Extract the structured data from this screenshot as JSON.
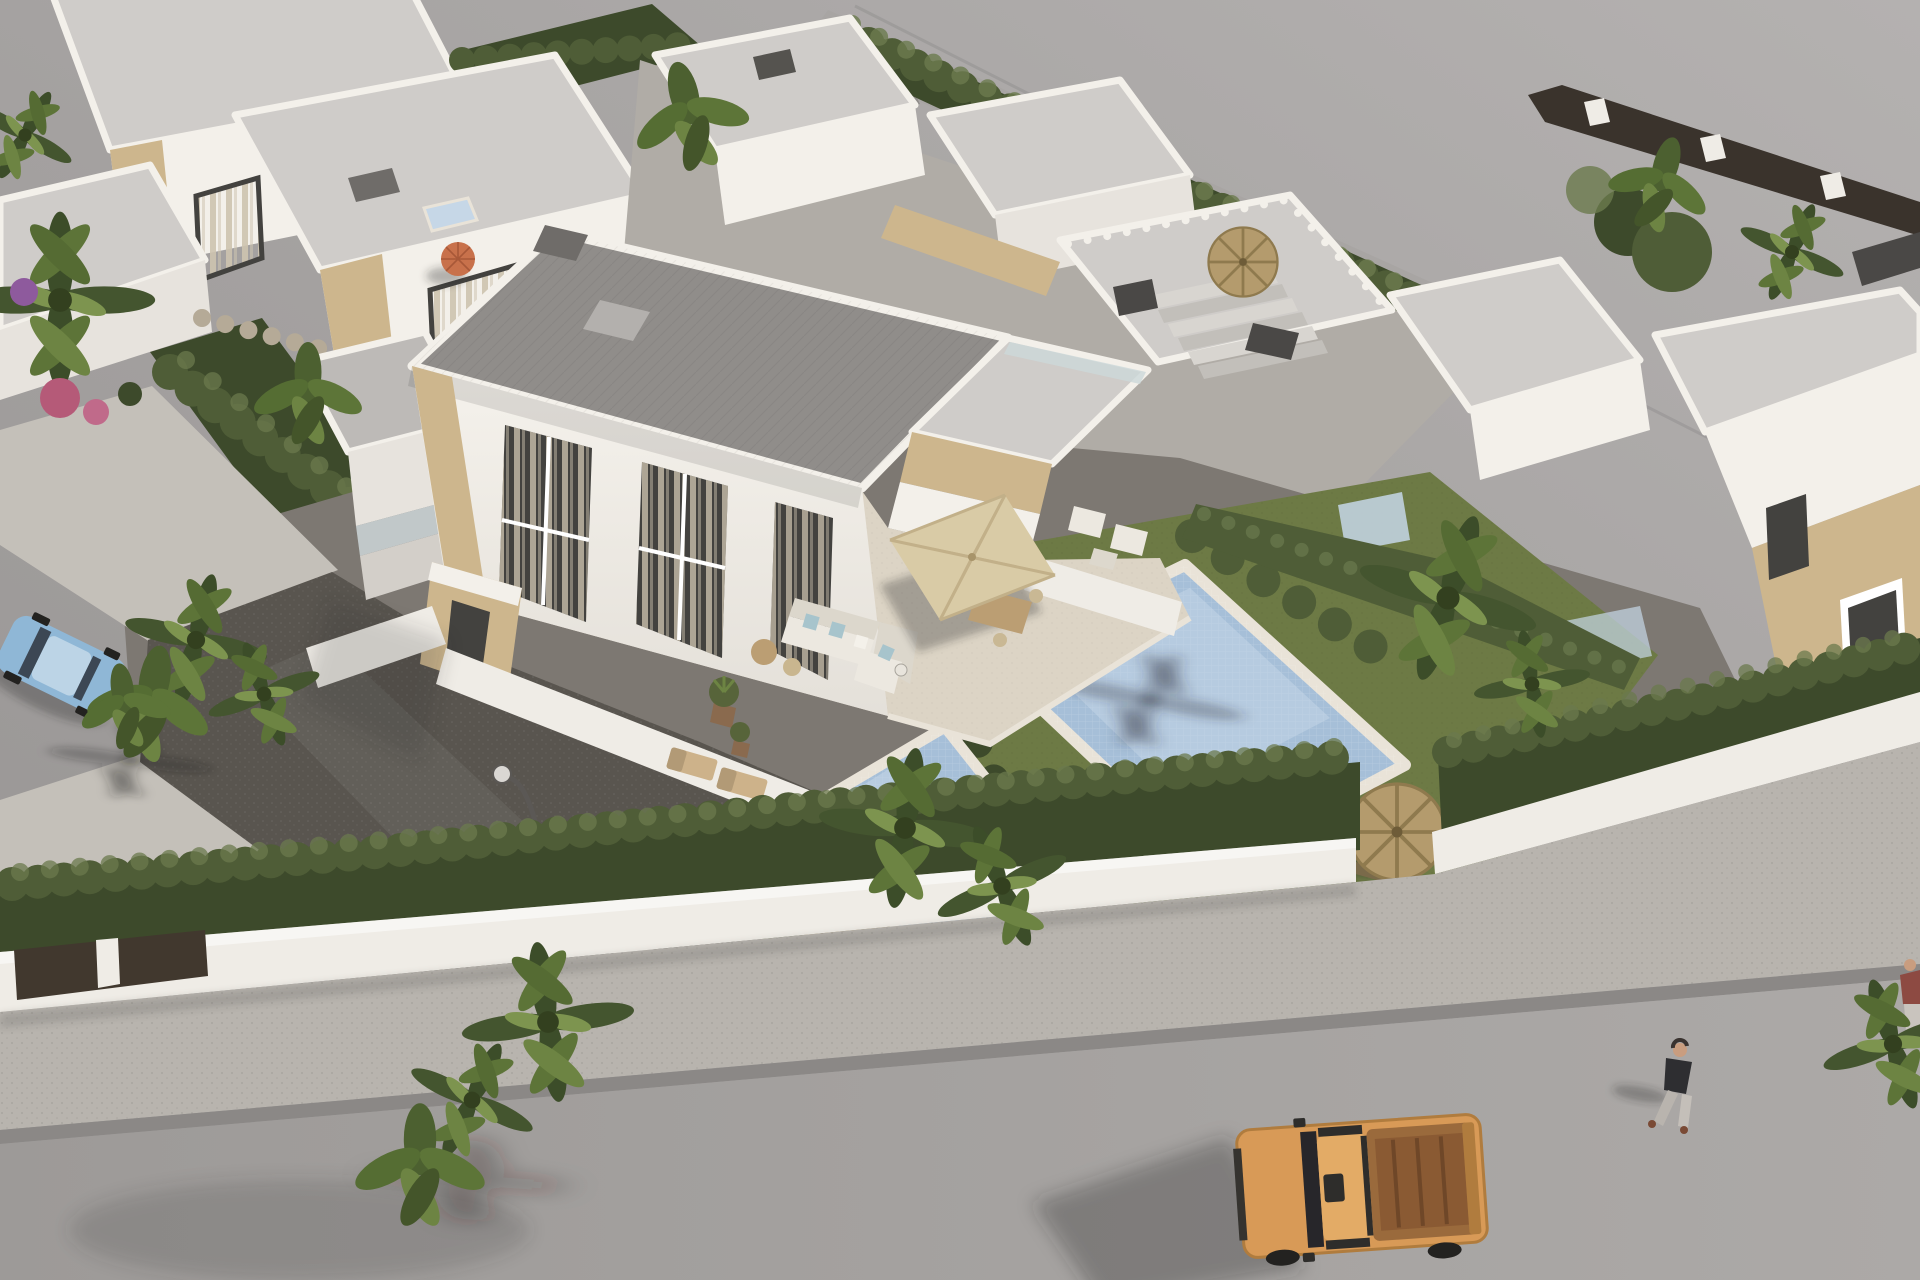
{
  "meta": {
    "title": "Aerial 3D architectural render of a new-build residential development: white flat-roof villas with stone accents, private mosaic pools, landscaped gardens and a street with vehicles",
    "view": "high-angle aerial",
    "time_of_day": "daytime"
  },
  "palette": {
    "bg1": "#b2afae",
    "bg2": "#989594",
    "roofL": "#cfccc9",
    "roofM": "#bdbab7",
    "roofD": "#908d8a",
    "wallB": "#f3f0ea",
    "wallL": "#e7e3dd",
    "wallS": "#d3cfc9",
    "wallD": "#c0bcb6",
    "stone": "#cdb68d",
    "stoneD": "#b29873",
    "glass": "#43423f",
    "curtain": "#cec4b0",
    "terr": "#dcd4c5",
    "terrS": "#cbc2b0",
    "poolW": "#a6bfd8",
    "poolL": "#c6d7e7",
    "cop": "#e9e3d8",
    "grass": "#6d7a45",
    "grassD": "#57643a",
    "hedge": "#4f5d37",
    "hedgeD": "#3d4a2b",
    "hedgeL": "#6b7a4e",
    "gravD": "#59554f",
    "gravM": "#7d7872",
    "pave": "#c4c0b9",
    "street": "#a6a3a1",
    "walk": "#b8b4ae",
    "curb": "#8b8886",
    "pwall": "#efece6",
    "gateC": "#41382e",
    "gate": "#41382e",
    "truck": "#d89a57",
    "truckD": "#b07c3e",
    "bed": "#8a5a33",
    "dark": "#2e2d2b",
    "carB": "#8fb7d6",
    "straw": "#b49b6d",
    "strawD": "#8f7a4e",
    "umb": "#d9cba6",
    "umbS": "#c2b089",
    "sofa": "#ece8e0",
    "sofaS": "#dcd7cc",
    "cushB": "#a7c4cc",
    "wood": "#bb9e73",
    "woodD": "#7a6a4a",
    "skin": "#c99d7f",
    "shad": "rgba(45,42,38,0.32)",
    "orangeUmb": "#c8714b",
    "flower": "#b55a78",
    "flower2": "#8e5a9d",
    "redCar": "#93392f",
    "grayCar": "#8f8c89"
  },
  "scene": {
    "street": {
      "elements": [
        "asphalt road",
        "speckled sidewalk",
        "white boundary wall",
        "dark entry gate panels",
        "street lamp"
      ],
      "vehicles": [
        {
          "name": "orange-pickup-truck",
          "position": "bottom right, parked on road"
        },
        {
          "name": "blue-sedan",
          "position": "left edge, parked"
        },
        {
          "name": "red-car",
          "position": "behind back hedge"
        },
        {
          "name": "gray-car",
          "position": "back lane, top centre"
        }
      ],
      "people": [
        {
          "name": "pedestrian-walking",
          "position": "sidewalk right"
        },
        {
          "name": "pedestrian-partial",
          "position": "right edge"
        }
      ]
    },
    "main_villa": {
      "stories": 2,
      "roof": "flat grey gravel with white parapet",
      "features": [
        "floor-to-ceiling windows with beige curtains",
        "travertine stone accent panels",
        "beige square parasol over dining set",
        "white L-shaped lounge sofa with blue cushions",
        "two timber sun loungers",
        "potted plants",
        "stone entrance porch"
      ]
    },
    "pools": {
      "count": 2,
      "style": "rotated rectangles, light mosaic water, pale stone coping, palm shadows"
    },
    "gardens": {
      "elements": [
        "dark gravel driveway",
        "stepping-stone path",
        "lawns",
        "straw palapa umbrellas",
        "wooden deck chairs",
        "picnic table",
        "cypress hedge rows",
        "timber deck steps",
        "bougainvillea",
        "rock border"
      ]
    },
    "background": {
      "elements": [
        "rows of white flat-roof villas",
        "roof terraces with stair runs",
        "dark chimney caps",
        "small plunge pool",
        "orange parasol",
        "perimeter hedges",
        "plain grey unbuilt ground"
      ]
    }
  },
  "counts": {
    "pools": 2,
    "fabric_parasols": 1,
    "orange_parasols": 1,
    "straw_palapas": 3,
    "palm_trees": 13,
    "vehicles": 4,
    "people": 2
  }
}
